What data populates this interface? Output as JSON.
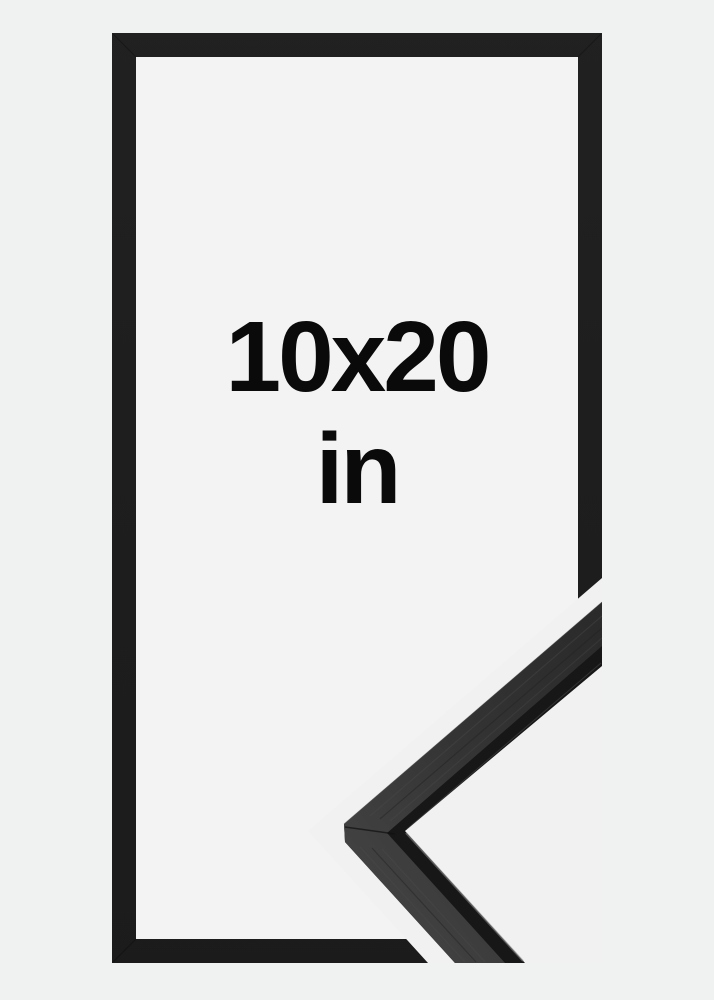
{
  "page": {
    "background_color": "#f0f1f1",
    "gap_color": "#f1f1f1"
  },
  "frame": {
    "size_label": "10x20",
    "unit_label": "in",
    "label_color": "#0a0a0a",
    "border_color": "#1e1e1e",
    "interior_color": "#f3f3f3"
  },
  "corner_detail": {
    "top_face_color": "#363636",
    "front_face_color": "#171717",
    "edge_highlight_color": "#8a8a8a"
  }
}
